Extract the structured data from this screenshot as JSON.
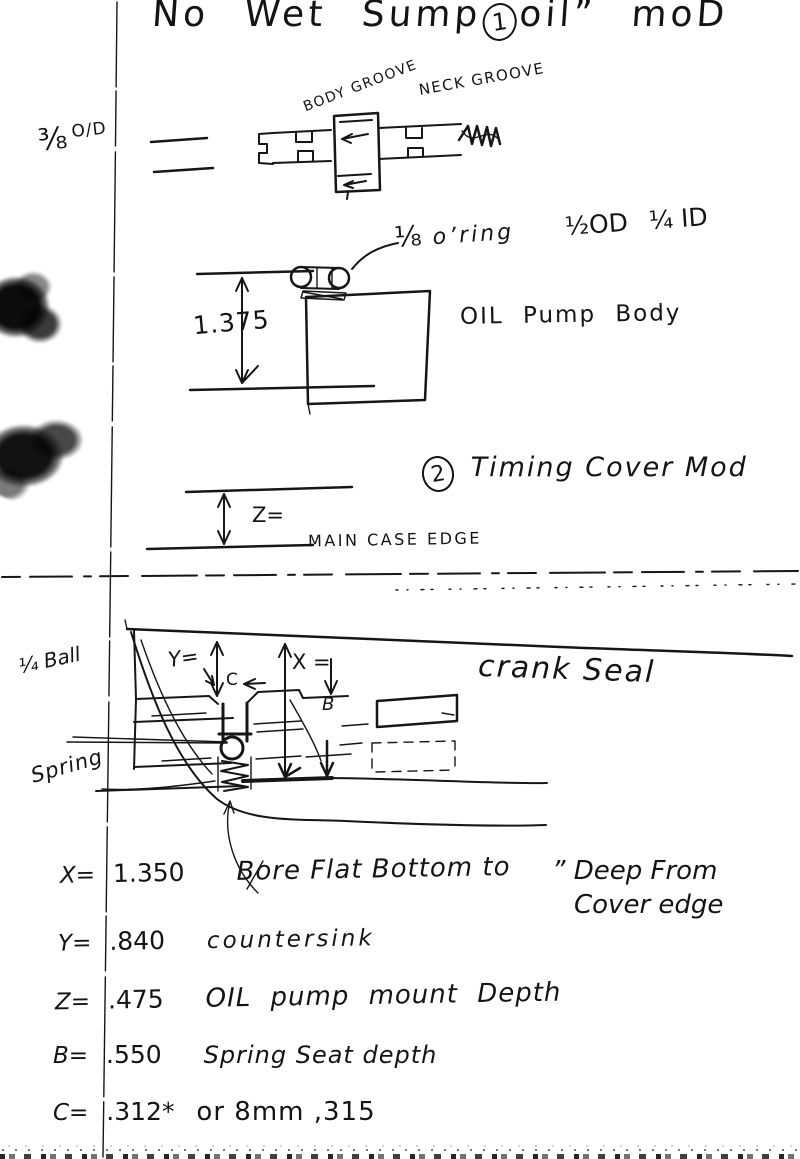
{
  "title": {
    "prefix": "No Wet Sump",
    "circled_number": "1",
    "suffix": "oil” moD"
  },
  "shaft": {
    "od_fraction": "⅜",
    "od_text": "O/D",
    "body_groove": "BODY GROOVE",
    "neck_groove": "NECK GROOVE"
  },
  "oring": {
    "size": "⅛",
    "word": "o’ring",
    "od": "½OD",
    "id": "¼ ID"
  },
  "pump": {
    "height_dim": "1.375",
    "body_label": "OIL Pump Body"
  },
  "timing": {
    "circled_number": "2",
    "heading": "Timing Cover Mod",
    "z_label": "Z=",
    "edge_label": "MAIN CASE EDGE"
  },
  "cover": {
    "ball_label": "¼ Ball",
    "spring_label": "Spring",
    "y_label": "Y=",
    "x_label": "X =",
    "c_label": "C",
    "b_label": "B",
    "seal_label": "crank Seal"
  },
  "notes": {
    "x": {
      "label": "X=",
      "value": "1.350",
      "desc": "Bore Flat Bottom to",
      "deep1": "” Deep From",
      "deep2": "Cover edge"
    },
    "y": {
      "label": "Y=",
      "value": ".840",
      "desc": "countersink"
    },
    "z": {
      "label": "Z=",
      "value": ".475",
      "desc": "OIL pump mount Depth"
    },
    "b": {
      "label": "B=",
      "value": ".550",
      "desc": "Spring Seat depth"
    },
    "c": {
      "label": "C=",
      "value": ".312*",
      "desc": "or 8mm ,315"
    }
  },
  "ink_color": "#161616",
  "paper_color": "#ffffff"
}
